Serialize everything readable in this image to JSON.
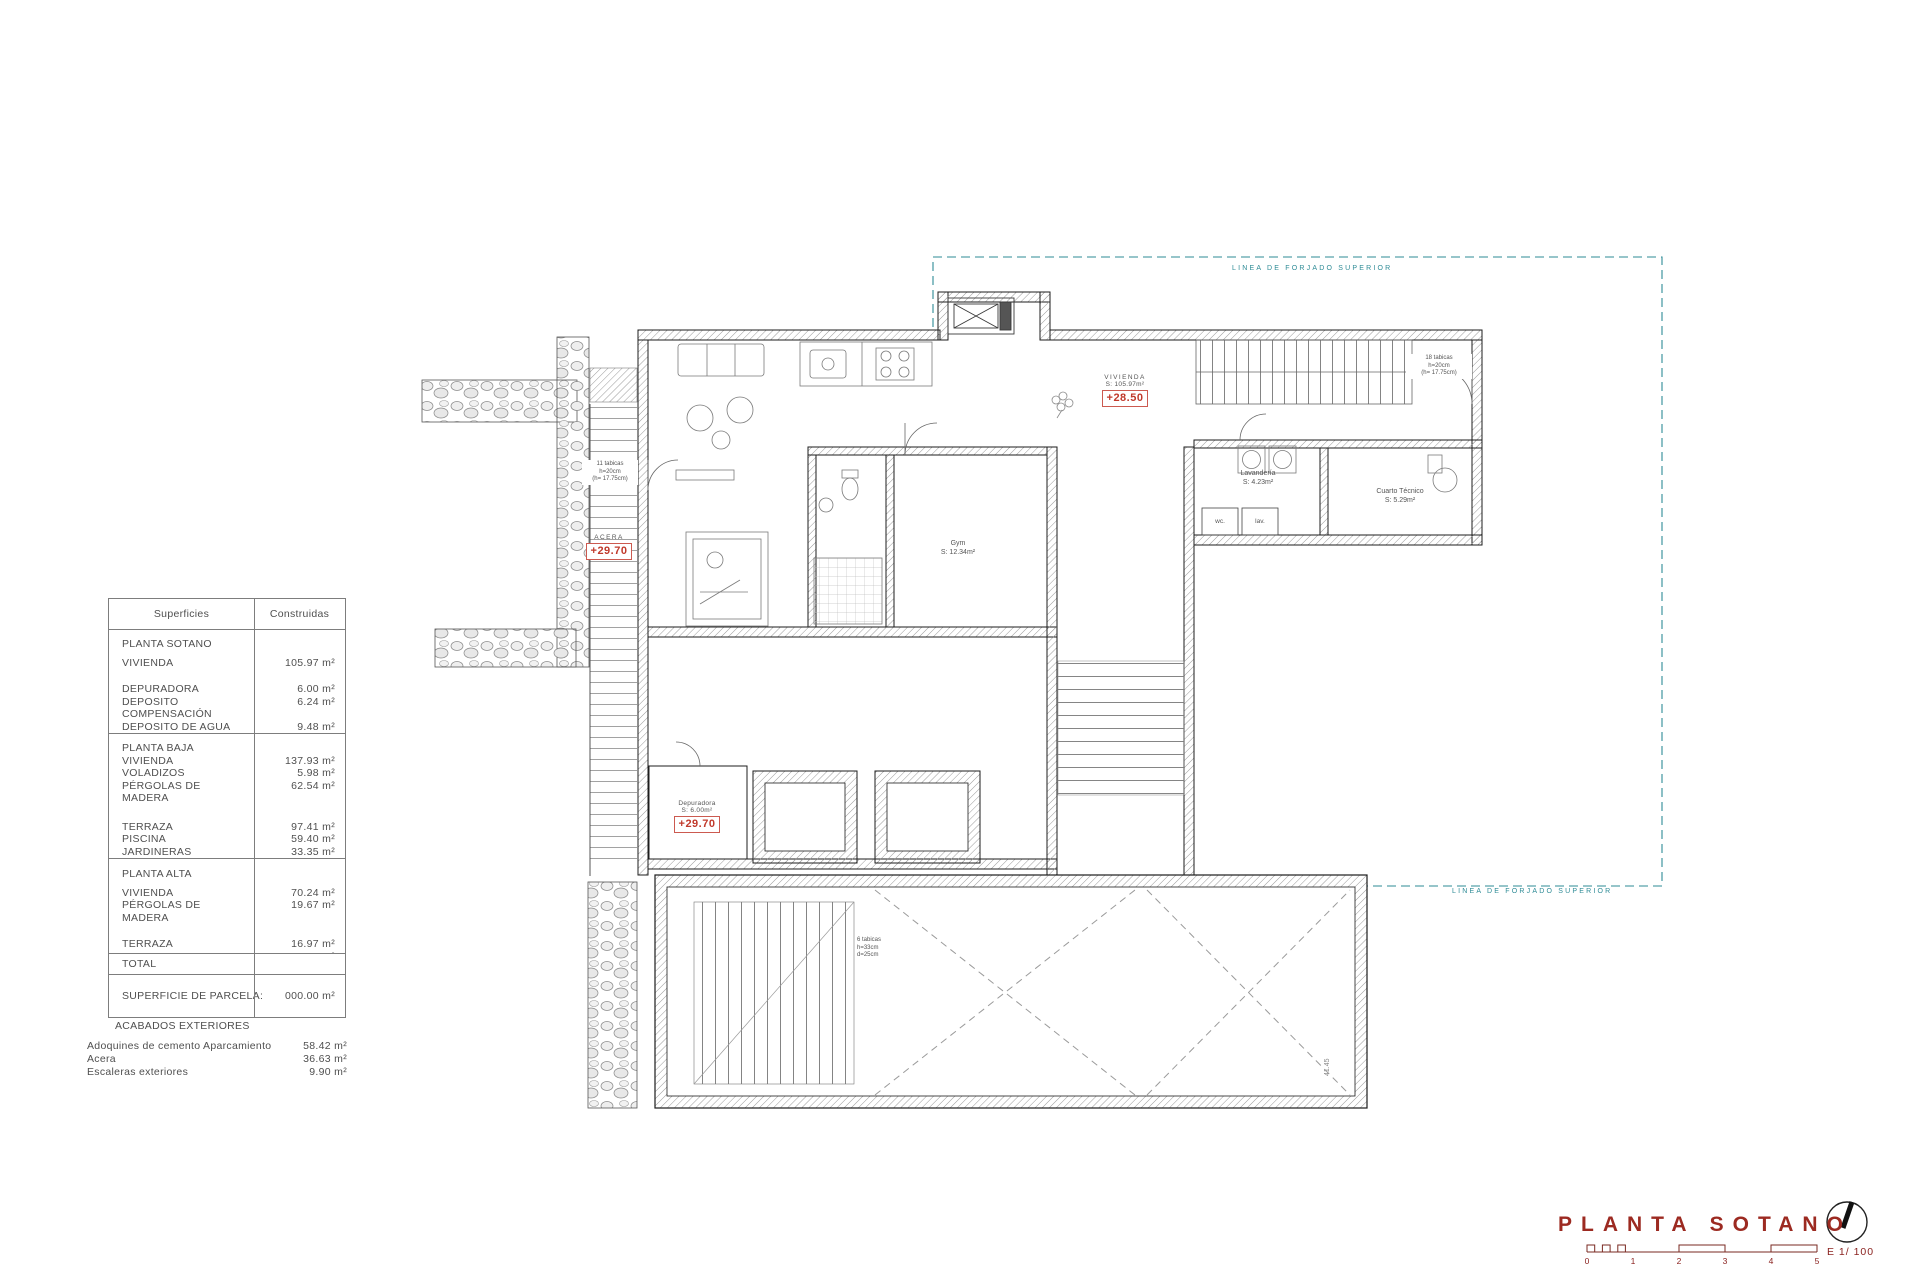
{
  "colors": {
    "accent_red": "#9c2a21",
    "marker_red": "#c0392b",
    "forjado_teal": "#2e8b96"
  },
  "surfaces_table": {
    "header": {
      "col1": "Superficies",
      "col2": "Construidas"
    },
    "sections": [
      {
        "title": "PLANTA SOTANO",
        "rows": [
          {
            "label": "VIVIENDA",
            "value": "105.97 m²"
          },
          {
            "label": "DEPURADORA",
            "value": "6.00 m²"
          },
          {
            "label": "DEPOSITO COMPENSACIÓN",
            "value": "6.24 m²"
          },
          {
            "label": "DEPOSITO DE AGUA",
            "value": "9.48 m²"
          }
        ]
      },
      {
        "title": "PLANTA BAJA",
        "rows": [
          {
            "label": "VIVIENDA",
            "value": "137.93 m²"
          },
          {
            "label": "VOLADIZOS",
            "value": "5.98 m²"
          },
          {
            "label": "PÉRGOLAS DE MADERA",
            "value": "62.54 m²"
          },
          {
            "label": "TERRAZA",
            "value": "97.41 m²"
          },
          {
            "label": "PISCINA",
            "value": "59.40 m²"
          },
          {
            "label": "JARDINERAS",
            "value": "33.35 m²"
          }
        ]
      },
      {
        "title": "PLANTA ALTA",
        "rows": [
          {
            "label": "VIVIENDA",
            "value": "70.24 m²"
          },
          {
            "label": "PÉRGOLAS DE MADERA",
            "value": "19.67 m²"
          },
          {
            "label": "TERRAZA",
            "value": "16.97 m²"
          },
          {
            "label": "SOLARIUM",
            "value": "25.02 m²"
          }
        ]
      },
      {
        "title": "TOTAL",
        "rows": []
      }
    ],
    "parcel_label": "SUPERFICIE DE PARCELA:",
    "parcel_value": "000.00 m²"
  },
  "exterior_finishes": {
    "title": "ACABADOS EXTERIORES",
    "rows": [
      {
        "label": "Adoquines de cemento Aparcamiento",
        "value": "58.42 m²"
      },
      {
        "label": "Acera",
        "value": "36.63 m²"
      },
      {
        "label": "Escaleras exteriores",
        "value": "9.90 m²"
      }
    ]
  },
  "plan": {
    "forjado_label": "LINEA DE FORJADO SUPERIOR",
    "level_vivienda": {
      "line1": "VIVIENDA",
      "line2": "S: 105.97m²",
      "value": "+28.50"
    },
    "level_acera": {
      "line1": "ACERA",
      "value": "+29.70"
    },
    "level_depuradora": {
      "line1": "Depuradora",
      "line2": "S: 6.00m²",
      "value": "+29.70"
    },
    "room_gym": {
      "line1": "Gym",
      "line2": "S: 12.34m²"
    },
    "room_lavanderia": {
      "line1": "Lavandería",
      "line2": "S: 4.23m²"
    },
    "room_cuarto_tecnico": {
      "line1": "Cuarto Técnico",
      "line2": "S: 5.29m²"
    },
    "wc_label": "wc.",
    "lav_label": "lav.",
    "note_stairs_right": {
      "l1": "18 tabicas",
      "l2": "h=20cm",
      "l3": "(h= 17.75cm)"
    },
    "note_stairs_left": {
      "l1": "11 tabicas",
      "l2": "h=20cm",
      "l3": "(h= 17.75cm)"
    },
    "note_stairs_garage": {
      "l1": "6 tabicas",
      "l2": "h=33cm",
      "l3": "d=25cm"
    },
    "dim_garage": "41.45"
  },
  "title_block": {
    "title": "PLANTA SOTANO",
    "scale_label": "E 1/ 100",
    "ticks": [
      "0",
      "1",
      "2",
      "3",
      "4",
      "5"
    ]
  }
}
